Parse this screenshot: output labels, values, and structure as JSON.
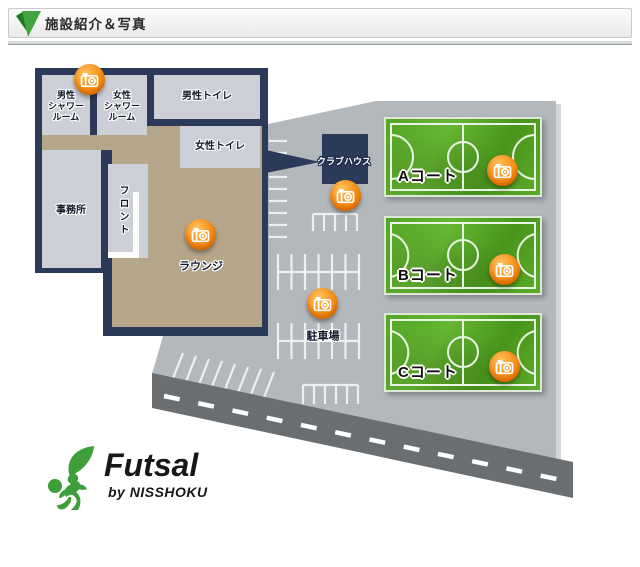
{
  "header": {
    "title": "施設紹介＆写真"
  },
  "building": {
    "rooms": {
      "mens_shower": "男性\nシャワー\nルーム",
      "womens_shower": "女性\nシャワー\nルーム",
      "mens_toilet": "男性トイレ",
      "womens_toilet": "女性トイレ",
      "office": "事務所",
      "front_desk": "フロント",
      "lounge": "ラウンジ"
    }
  },
  "grounds": {
    "clubhouse": "クラブハウス",
    "parking": "駐車場"
  },
  "courts": [
    {
      "id": "A",
      "label": "Aコート"
    },
    {
      "id": "B",
      "label": "Bコート"
    },
    {
      "id": "C",
      "label": "Cコート"
    }
  ],
  "logo": {
    "brand": "Futsal",
    "byline": "by NISSHOKU"
  },
  "icons": {
    "camera": "camera-icon",
    "header_marker": "green-ribbon-icon"
  },
  "colors": {
    "wall_navy": "#2b3a58",
    "room_gray": "#ccd0d6",
    "corridor_tan": "#b5a58b",
    "ground_gray": "#b3b8bc",
    "road_gray": "#6a6e71",
    "court_green": "#4f9e22",
    "camera_orange": "#f07d00",
    "logo_green": "#3e9e39",
    "header_green": "#3a9e3a"
  }
}
